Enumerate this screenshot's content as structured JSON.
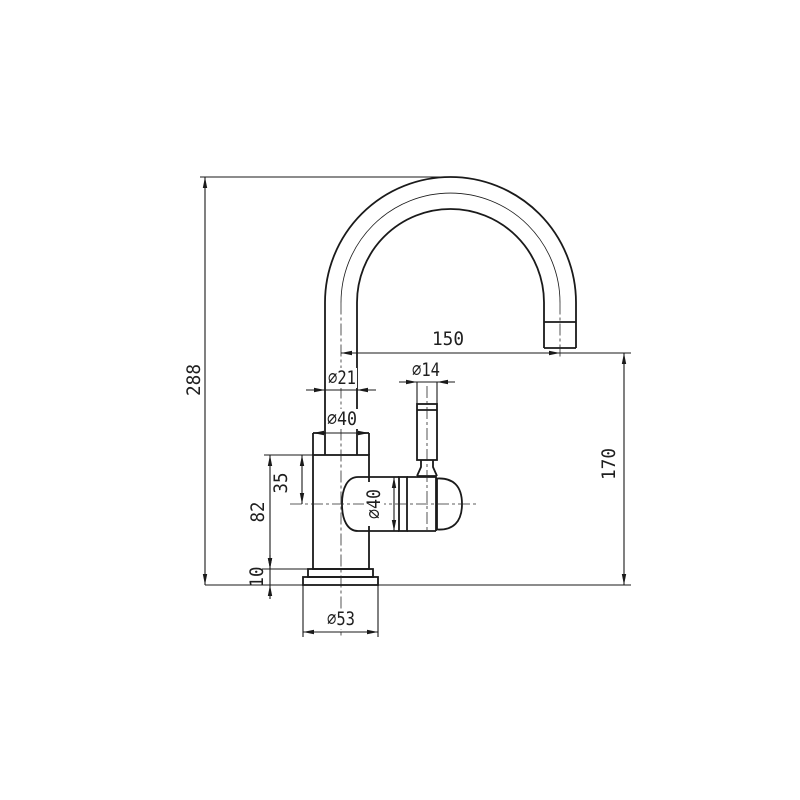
{
  "document": {
    "type": "technical-dimension-drawing",
    "subject": "single-lever mixer tap side elevation",
    "background": "#ffffff",
    "line_color": "#1a1a1a"
  },
  "dimensions": {
    "overall_height": "288",
    "spout_reach": "150",
    "spout_height": "170",
    "pipe_diameter": "⌀21",
    "neck_diameter": "⌀40",
    "handle_diameter": "⌀14",
    "valve_diameter": "⌀40",
    "body_top_to_valve_center": "35",
    "body_height": "82",
    "base_height": "10",
    "base_diameter": "⌀53"
  }
}
